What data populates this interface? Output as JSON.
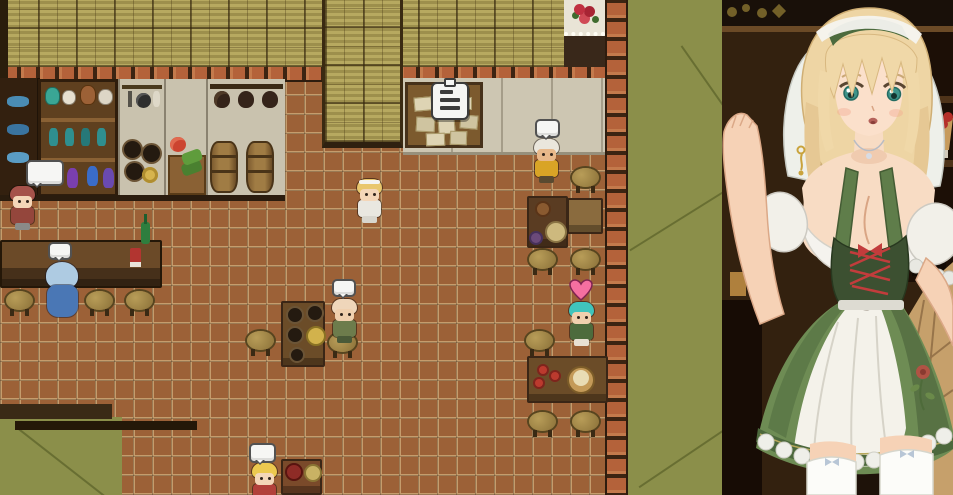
{
  "scene": {
    "title": "tavern-interior-map",
    "icons": {
      "speech_bubble": {
        "shape": "blank-white-rounded-square-with-tail",
        "fill": "#f6f6f4",
        "border": "#525252"
      },
      "heart": {
        "fill": "#f56fa0",
        "border": "#7e2450"
      },
      "notice_clipboard": {
        "fill": "#f5f5f3",
        "lines": 3,
        "border": "#3c3c3c"
      }
    },
    "npcs": [
      {
        "id": "shopkeeper",
        "label": "red-haired shopkeeper",
        "x": 8,
        "y": 186,
        "style": "default",
        "hair": "#a5524a",
        "skin": "#f4d6b8",
        "outfit": "#94463c",
        "legs": "#8a8a88",
        "bubble": {
          "x": 26,
          "y": 160,
          "w": 38,
          "h": 26
        }
      },
      {
        "id": "patron-blue",
        "label": "hooded patron seated at bar",
        "x": 46,
        "y": 262,
        "style": "robed",
        "hood": "#aecbe2",
        "robe": "#4a77b5",
        "bubble": {
          "x": 48,
          "y": 242,
          "w": 24,
          "h": 18
        }
      },
      {
        "id": "waitress-sprite",
        "label": "blonde waitress",
        "x": 355,
        "y": 179,
        "style": "default",
        "hair": "#e9c76d",
        "band": "#f4f4f0",
        "skin": "#f4d6b8",
        "outfit": "#e9e7e0",
        "legs": "#d8d6ce"
      },
      {
        "id": "cook",
        "label": "turbaned cook",
        "x": 532,
        "y": 139,
        "style": "default",
        "hair": "#eae6dc",
        "skin": "#e8b88a",
        "outfit": "#d9a426",
        "legs": "#5a4a30",
        "bubble": {
          "x": 535,
          "y": 119,
          "w": 25,
          "h": 19
        }
      },
      {
        "id": "patron-bald",
        "label": "bald patron at keg table",
        "x": 330,
        "y": 299,
        "style": "default",
        "hair": "#efd6ba",
        "skin": "#f0d0ae",
        "outfit": "#6d7c4c",
        "legs": "#4a5a38",
        "bubble": {
          "x": 332,
          "y": 279,
          "w": 24,
          "h": 18
        }
      },
      {
        "id": "adventurer-teal",
        "label": "teal-haired adventurer",
        "x": 567,
        "y": 302,
        "style": "default",
        "hair": "#40c4bc",
        "skin": "#f0d0ae",
        "outfit": "#4d6b3d",
        "legs": "#e8e0d2",
        "heart": {
          "x": 569,
          "y": 279,
          "w": 24,
          "h": 22
        }
      },
      {
        "id": "child",
        "label": "blonde child",
        "x": 250,
        "y": 463,
        "style": "default",
        "hair": "#ecc94f",
        "skin": "#f4d6b8",
        "outfit": "#b2403a",
        "legs": "#7a3a34",
        "bubble": {
          "x": 249,
          "y": 443,
          "w": 27,
          "h": 20
        }
      }
    ],
    "furniture": {
      "stools": [
        {
          "x": 6,
          "y": 291
        },
        {
          "x": 86,
          "y": 291
        },
        {
          "x": 126,
          "y": 291
        },
        {
          "x": 247,
          "y": 331
        },
        {
          "x": 329,
          "y": 333
        },
        {
          "x": 572,
          "y": 168
        },
        {
          "x": 529,
          "y": 250
        },
        {
          "x": 572,
          "y": 250
        },
        {
          "x": 526,
          "y": 331
        },
        {
          "x": 529,
          "y": 412
        },
        {
          "x": 572,
          "y": 412
        }
      ],
      "tables": [
        {
          "id": "bar-counter",
          "x": 0,
          "y": 240,
          "w": 162,
          "h": 48,
          "cls": "counter",
          "color": "#5d4026",
          "items": [
            {
              "t": "r",
              "x": 139,
              "y": -20,
              "w": 9,
              "h": 22,
              "c": "#2e7e3e",
              "rx": 3
            },
            {
              "t": "r",
              "x": 142,
              "y": -28,
              "w": 3,
              "h": 10,
              "c": "#1e5e2e"
            },
            {
              "t": "r",
              "x": 128,
              "y": 6,
              "w": 11,
              "h": 16,
              "c": "#b23530",
              "rx": 2
            },
            {
              "t": "r",
              "x": 128,
              "y": 20,
              "w": 11,
              "h": 5,
              "c": "#e8e4da"
            }
          ]
        },
        {
          "id": "keg-table",
          "x": 281,
          "y": 301,
          "w": 44,
          "h": 66,
          "color": "#6b4c28",
          "items": [
            {
              "t": "c",
              "x": 12,
              "y": 12,
              "r": 9,
              "c": "#241a10",
              "e": "#6b5436"
            },
            {
              "t": "c",
              "x": 32,
              "y": 10,
              "r": 9,
              "c": "#241a10",
              "e": "#6b5436"
            },
            {
              "t": "c",
              "x": 12,
              "y": 32,
              "r": 9,
              "c": "#241a10",
              "e": "#6b5436"
            },
            {
              "t": "c",
              "x": 33,
              "y": 33,
              "r": 10,
              "c": "#d2b24c",
              "e": "#8a7224"
            },
            {
              "t": "c",
              "x": 14,
              "y": 52,
              "r": 8,
              "c": "#241a10",
              "e": "#6b5436"
            }
          ]
        },
        {
          "id": "cook-table",
          "x": 527,
          "y": 196,
          "w": 41,
          "h": 52,
          "color": "#5a3c22",
          "items": [
            {
              "t": "c",
              "x": 14,
              "y": 11,
              "r": 8,
              "c": "#8a5a30",
              "e": "#5a3418"
            },
            {
              "t": "c",
              "x": 27,
              "y": 34,
              "r": 11,
              "c": "#cdb97e",
              "e": "#8a7444"
            },
            {
              "t": "c",
              "x": 7,
              "y": 40,
              "r": 7,
              "c": "#6b4a7a",
              "e": "#46305a"
            }
          ]
        },
        {
          "id": "side-table",
          "x": 567,
          "y": 198,
          "w": 36,
          "h": 36,
          "color": "#8a6b3e",
          "items": []
        },
        {
          "id": "apple-table",
          "x": 527,
          "y": 356,
          "w": 81,
          "h": 47,
          "color": "#6b4c28",
          "items": [
            {
              "t": "c",
              "x": 14,
              "y": 12,
              "r": 6,
              "c": "#bb3a2e",
              "e": "#7e241c"
            },
            {
              "t": "c",
              "x": 26,
              "y": 18,
              "r": 6,
              "c": "#bb3a2e",
              "e": "#7e241c"
            },
            {
              "t": "c",
              "x": 10,
              "y": 25,
              "r": 6,
              "c": "#bb3a2e",
              "e": "#7e241c"
            },
            {
              "t": "c",
              "x": 52,
              "y": 22,
              "r": 14,
              "c": "#c49a58",
              "e": "#7c5c28"
            },
            {
              "t": "c",
              "x": 52,
              "y": 20,
              "r": 8,
              "c": "#e9dcb4"
            }
          ]
        },
        {
          "id": "child-table",
          "x": 281,
          "y": 459,
          "w": 41,
          "h": 36,
          "color": "#7a4a2a",
          "items": [
            {
              "t": "c",
              "x": 11,
              "y": 11,
              "r": 9,
              "c": "#8e2b26",
              "e": "#58140f"
            },
            {
              "t": "c",
              "x": 30,
              "y": 12,
              "r": 9,
              "c": "#c9b264",
              "e": "#8a7434"
            }
          ]
        }
      ],
      "notice_papers": [
        {
          "x": 6,
          "y": 12,
          "w": 16,
          "h": 12,
          "r": -5
        },
        {
          "x": 26,
          "y": 8,
          "w": 15,
          "h": 15,
          "r": 4
        },
        {
          "x": 46,
          "y": 12,
          "w": 16,
          "h": 11,
          "r": 0
        },
        {
          "x": 8,
          "y": 32,
          "w": 17,
          "h": 13,
          "r": 3
        },
        {
          "x": 30,
          "y": 30,
          "w": 15,
          "h": 17,
          "r": -4
        },
        {
          "x": 52,
          "y": 30,
          "w": 16,
          "h": 12,
          "r": 5
        },
        {
          "x": 18,
          "y": 48,
          "w": 17,
          "h": 11,
          "r": -2
        },
        {
          "x": 42,
          "y": 46,
          "w": 15,
          "h": 12,
          "r": 2
        }
      ],
      "paper_colors": [
        "#ded4b4",
        "#cfc4a0"
      ]
    },
    "portrait": {
      "subject": "blonde waitress in green-and-white dirndl with white veil",
      "hair_color": "#eed5a4",
      "eye_color": "#3e948a",
      "dress_green": "#6e8c54",
      "apron_white": "#f4f2ea"
    }
  }
}
